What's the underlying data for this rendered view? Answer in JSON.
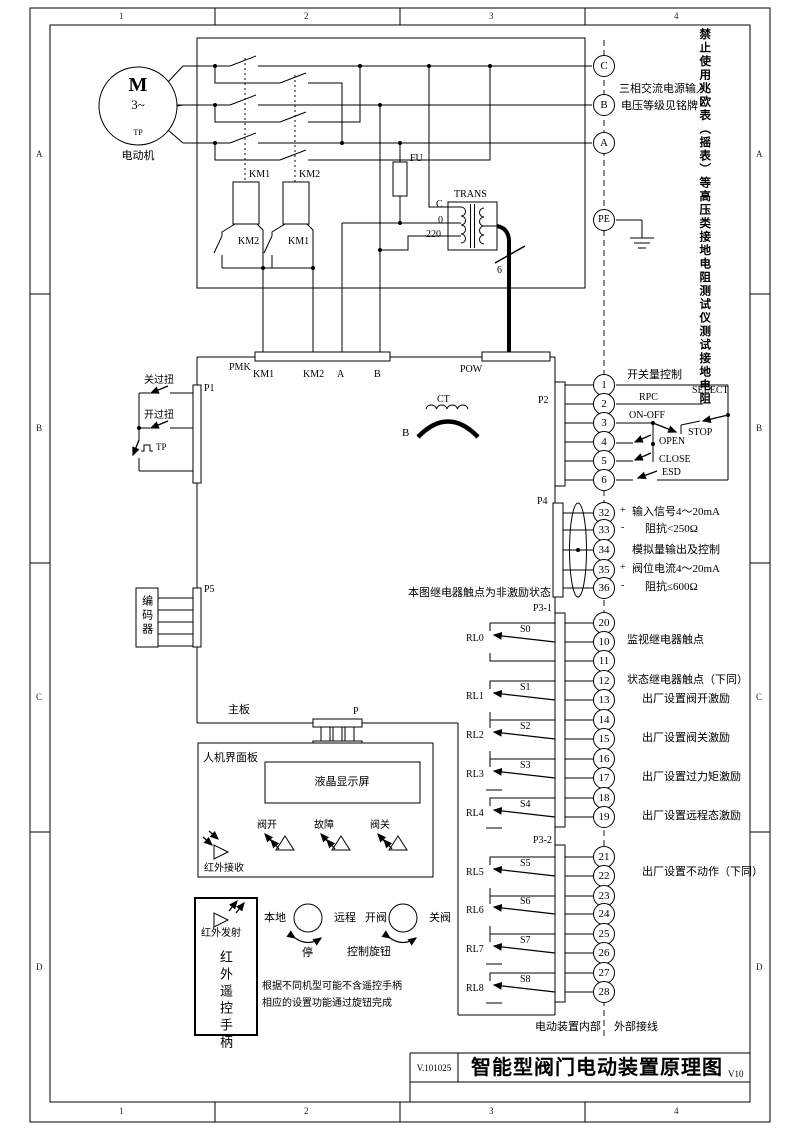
{
  "frame": {
    "c1": "1",
    "c2": "2",
    "c3": "3",
    "c4": "4",
    "rA": "A",
    "rB": "B",
    "rC": "C",
    "rD": "D"
  },
  "titleblock": {
    "doc": "V.101025",
    "title": "智能型阀门电动装置原理图",
    "ver": "V10"
  },
  "warning": "禁止使用兆欧表（摇表）等高压类接地电阻测试仪测试接地电阻",
  "supply": {
    "l1": "三相交流电源输入",
    "l2": "电压等级见铭牌",
    "tC": "C",
    "tB": "B",
    "tA": "A",
    "tPE": "PE"
  },
  "motor": {
    "m": "M",
    "ph": "3~",
    "tp": "TP",
    "name": "电动机"
  },
  "power": {
    "km1": "KM1",
    "km2": "KM2",
    "nc1": "KM2",
    "nc2": "KM1",
    "fu": "FU",
    "trans": "TRANS",
    "pC": "C",
    "p0": "0",
    "p220": "220",
    "cable": "6"
  },
  "bars": {
    "pmk": "PMK",
    "pin1": "KM1",
    "pin2": "KM2",
    "pin3": "A",
    "pin4": "B",
    "pow": "POW",
    "p": "P",
    "p1": "P1",
    "p2": "P2",
    "p4": "P4",
    "p5": "P5",
    "p31": "P3-1",
    "p32": "P3-2"
  },
  "left": {
    "closeTorque": "关过扭",
    "openTorque": "开过扭",
    "tp": "TP",
    "encoder": "编码器",
    "mainboard": "主板"
  },
  "ct": {
    "label": "CT",
    "phase": "B"
  },
  "sw": {
    "title": "开关量控制",
    "select": "SELECT",
    "rpc": "RPC",
    "onoff": "ON-OFF",
    "stop": "STOP",
    "open": "OPEN",
    "close": "CLOSE",
    "esd": "ESD",
    "t1": "1",
    "t2": "2",
    "t3": "3",
    "t4": "4",
    "t5": "5",
    "t6": "6"
  },
  "analog": {
    "t32": "32",
    "t33": "33",
    "t34": "34",
    "t35": "35",
    "t36": "36",
    "s32": "+",
    "s33": "-",
    "s35": "+",
    "s36": "-",
    "l1": "输入信号4～20mA",
    "l2": "阻抗<250Ω",
    "l3": "模拟量输出及控制",
    "l4": "阀位电流4～20mA",
    "l5": "阻抗≤600Ω"
  },
  "relaynote": "本图继电器触点为非激励状态",
  "p31": {
    "t20": "20",
    "t10": "10",
    "t11": "11",
    "t12": "12",
    "t13": "13",
    "t14": "14",
    "t15": "15",
    "t16": "16",
    "t17": "17",
    "t18": "18",
    "t19": "19",
    "rl0": "RL0",
    "s0": "S0",
    "rl1": "RL1",
    "s1": "S1",
    "rl2": "RL2",
    "s2": "S2",
    "rl3": "RL3",
    "s3": "S3",
    "rl4": "RL4",
    "s4": "S4",
    "n1": "监视继电器触点",
    "n2": "状态继电器触点（下同）",
    "n3": "出厂设置阀开激励",
    "n4": "出厂设置阀关激励",
    "n5": "出厂设置过力矩激励",
    "n6": "出厂设置远程态激励"
  },
  "p32": {
    "t21": "21",
    "t22": "22",
    "t23": "23",
    "t24": "24",
    "t25": "25",
    "t26": "26",
    "t27": "27",
    "t28": "28",
    "rl5": "RL5",
    "s5": "S5",
    "rl6": "RL6",
    "s6": "S6",
    "rl7": "RL7",
    "s7": "S7",
    "rl8": "RL8",
    "s8": "S8",
    "n": "出厂设置不动作（下同）"
  },
  "hmi": {
    "panel": "人机界面板",
    "lcd": "液晶显示屏",
    "ledOpen": "阀开",
    "ledFault": "故障",
    "ledClose": "阀关",
    "irRx": "红外接收",
    "irTx": "红外发射",
    "remote": "红外遥控手柄"
  },
  "knobs": {
    "local": "本地",
    "remote": "远程",
    "stop": "停",
    "open": "开阀",
    "close": "关阀",
    "label": "控制旋钮",
    "note1": "根据不同机型可能不含遥控手柄",
    "note2": "相应的设置功能通过旋钮完成"
  },
  "boundary": {
    "inner": "电动装置内部",
    "outer": "外部接线"
  }
}
